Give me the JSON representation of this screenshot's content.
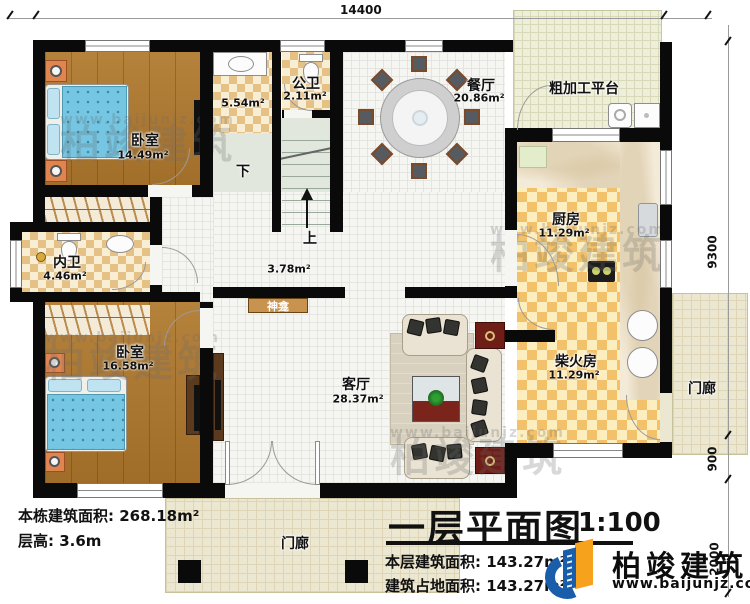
{
  "dimensions": {
    "top": "14400",
    "right": [
      "9300",
      "900",
      "2000"
    ]
  },
  "rooms": {
    "bedroom1": {
      "name": "卧室",
      "area": "14.49m²"
    },
    "bath": {
      "area": "5.54m²"
    },
    "public_wc": {
      "name": "公卫",
      "area": "2.11m²"
    },
    "dining": {
      "name": "餐厅",
      "area": "20.86m²"
    },
    "platform": {
      "name": "粗加工平台"
    },
    "kitchen": {
      "name": "厨房",
      "area": "11.29m²"
    },
    "inner_wc": {
      "name": "内卫",
      "area": "4.46m²"
    },
    "bedroom2": {
      "name": "卧室",
      "area": "16.58m²"
    },
    "firewood": {
      "name": "柴火房",
      "area": "11.29m²"
    },
    "living": {
      "name": "客厅",
      "area": "28.37m²"
    },
    "hallway": {
      "area": "3.78m²"
    },
    "shrine": {
      "name": "神龛"
    },
    "porch_bottom": {
      "name": "门廊"
    },
    "porch_right": {
      "name": "门廊"
    }
  },
  "stairs": {
    "down": "下",
    "up": "上"
  },
  "notes": {
    "building_total_area": "本栋建筑面积: 268.18m²",
    "floor_height": "层高: 3.6m"
  },
  "title_block": {
    "title": "一层平面图",
    "scale": "1:100",
    "floor_area": "本层建筑面积: 143.27m²",
    "footprint_area": "建筑占地面积: 143.27m²"
  },
  "brand": {
    "name": "柏竣建筑",
    "url": "www.baijunjz.com"
  },
  "watermark": {
    "name": "柏竣建筑",
    "url": "www.baijunjz.com"
  },
  "colors": {
    "wall": "#0a0a0a",
    "logo_blue": "#1a5dab",
    "logo_orange": "#f7a21d",
    "wood_floor": "#ad7a33",
    "bed": "#74c6e2"
  }
}
